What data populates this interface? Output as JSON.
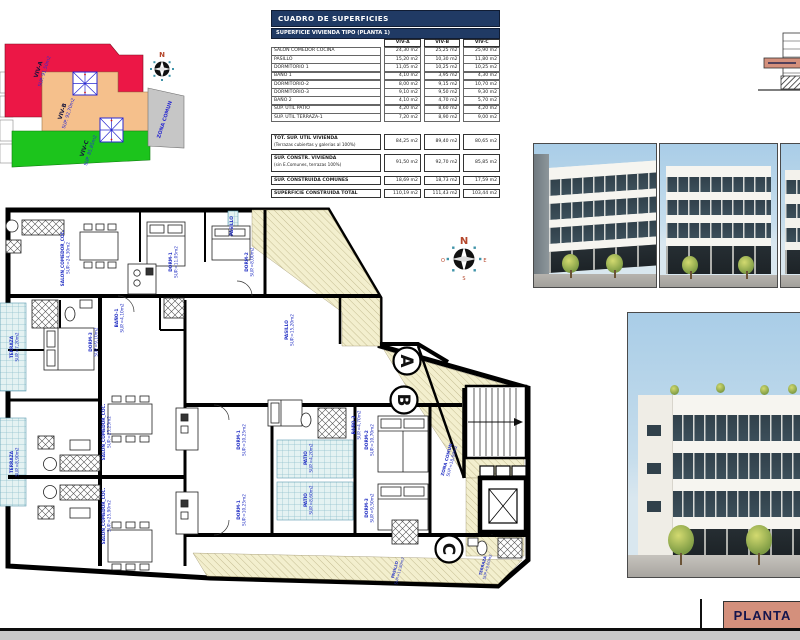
{
  "page": {
    "sheet_label": "PLANTA"
  },
  "surface_table": {
    "title": "CUADRO DE SUPERFICIES",
    "subtitle": "SUPERFICIE VIVIENDA TIPO  (PLANTA 1)",
    "columns": [
      "VIV-A",
      "VIV-B",
      "VIV-C"
    ],
    "rows": [
      {
        "label": "SALON COMEDOR COCINA",
        "a": "24,30 m2",
        "b": "25,25 m2",
        "c": "25,90 m2"
      },
      {
        "label": "PASILLO",
        "a": "15,20 m2",
        "b": "10,30 m2",
        "c": "11,80 m2"
      },
      {
        "label": "DORMITORIO 1",
        "a": "11,05 m2",
        "b": "10,25 m2",
        "c": "10,25 m2"
      },
      {
        "label": "BAÑO 1",
        "a": "4,10 m2",
        "b": "3,95 m2",
        "c": "4,30 m2"
      },
      {
        "label": "DORMITORIO-2",
        "a": "8,00 m2",
        "b": "9,15 m2",
        "c": "10,70 m2"
      },
      {
        "label": "DORMITORIO-3",
        "a": "9,10 m2",
        "b": "9,50 m2",
        "c": "9,30 m2"
      },
      {
        "label": "BAÑO 2",
        "a": "4,10 m2",
        "b": "4,70 m2",
        "c": "5,70 m2"
      },
      {
        "label": "SUP. UTIL PATIO",
        "a": "4,20 m2",
        "b": "8,60 m2",
        "c": "4,20 m2"
      },
      {
        "label": "SUP. UTIL TERRAZA-1",
        "a": "7,20 m2",
        "b": "8,90 m2",
        "c": "9,00 m2"
      }
    ],
    "summary": [
      {
        "label": "TOT. SUP. UTIL VIVIENDA",
        "sublabel": "(Terrazas cubiertas y galerias al 100%)",
        "a": "84,25 m2",
        "b": "89,40 m2",
        "c": "80,65 m2"
      },
      {
        "label": "SUP. CONSTR. VIVIENDA",
        "sublabel": "(sin E.Comunes, terrazas 100%)",
        "a": "91,50 m2",
        "b": "92,70 m2",
        "c": "85,85 m2"
      },
      {
        "label": "SUP. CONSTRUIDA COMUNES",
        "sublabel": "",
        "a": "18,69 m2",
        "b": "18,73 m2",
        "c": "17,59 m2"
      },
      {
        "label": "SUPERFICIE CONSTRUIDA TOTAL",
        "sublabel": "",
        "a": "110,19 m2",
        "b": "111,43 m2",
        "c": "103,44 m2"
      }
    ]
  },
  "site_plan": {
    "compass_n": "N",
    "areas": [
      {
        "label": "VIV-A",
        "sup": "SUP. 91,50m2",
        "color": "#ec1746"
      },
      {
        "label": "VIV-B",
        "sup": "SUP. 92,70m2",
        "color": "#f5c08c"
      },
      {
        "label": "VIV-C",
        "sup": "SUP. 85,85m2",
        "color": "#1cc41c"
      },
      {
        "label": "ZONA COMUN",
        "sup": "",
        "color": "#c6c6c6"
      }
    ]
  },
  "floor_plan": {
    "section_marks": [
      "A",
      "B",
      "C"
    ],
    "compass": {
      "n": "N",
      "e": "E",
      "s": "S",
      "o": "O"
    },
    "labels": [
      {
        "text": "TERRAZA",
        "sup": "SUP.=7,20m2"
      },
      {
        "text": "TERRAZA",
        "sup": "SUP.=8,90m2"
      },
      {
        "text": "SALON_COMEDOR_COC.",
        "sup": "SUP.=24,30m2"
      },
      {
        "text": "DORM-1",
        "sup": "SUP.=11,05m2"
      },
      {
        "text": "DORM-2",
        "sup": "SUP.=8,00m2"
      },
      {
        "text": "PASILLO",
        "sup": ""
      },
      {
        "text": "BAÑO-1",
        "sup": "SUP.=4,10m2"
      },
      {
        "text": "DORM-3",
        "sup": "SUP.=9,10m2"
      },
      {
        "text": "PASILLO",
        "sup": "SUP.=15,20m2"
      },
      {
        "text": "SALON_COMEDOR_COC.",
        "sup": "SUP.=25,25m2"
      },
      {
        "text": "SALON_COMEDOR_COC.",
        "sup": "SUP.=25,90m2"
      },
      {
        "text": "DORM-1",
        "sup": "SUP.=10,25m2"
      },
      {
        "text": "DORM-1",
        "sup": "SUP.=10,25m2"
      },
      {
        "text": "PATIO",
        "sup": "SUP.=4,20m2"
      },
      {
        "text": "PATIO",
        "sup": "SUP.=8,60m2"
      },
      {
        "text": "DORM-2",
        "sup": "SUP.=10,70m2"
      },
      {
        "text": "DORM-3",
        "sup": "SUP.=9,50m2"
      },
      {
        "text": "BAÑO-2",
        "sup": "SUP.=4,70m2"
      },
      {
        "text": "ZONA COMUN",
        "sup": "SUP.=18,69m2"
      },
      {
        "text": "PASILLO",
        "sup": "SUP.=11,80m2"
      },
      {
        "text": "TERRAZA",
        "sup": "SUP.=9,00m2"
      }
    ]
  }
}
